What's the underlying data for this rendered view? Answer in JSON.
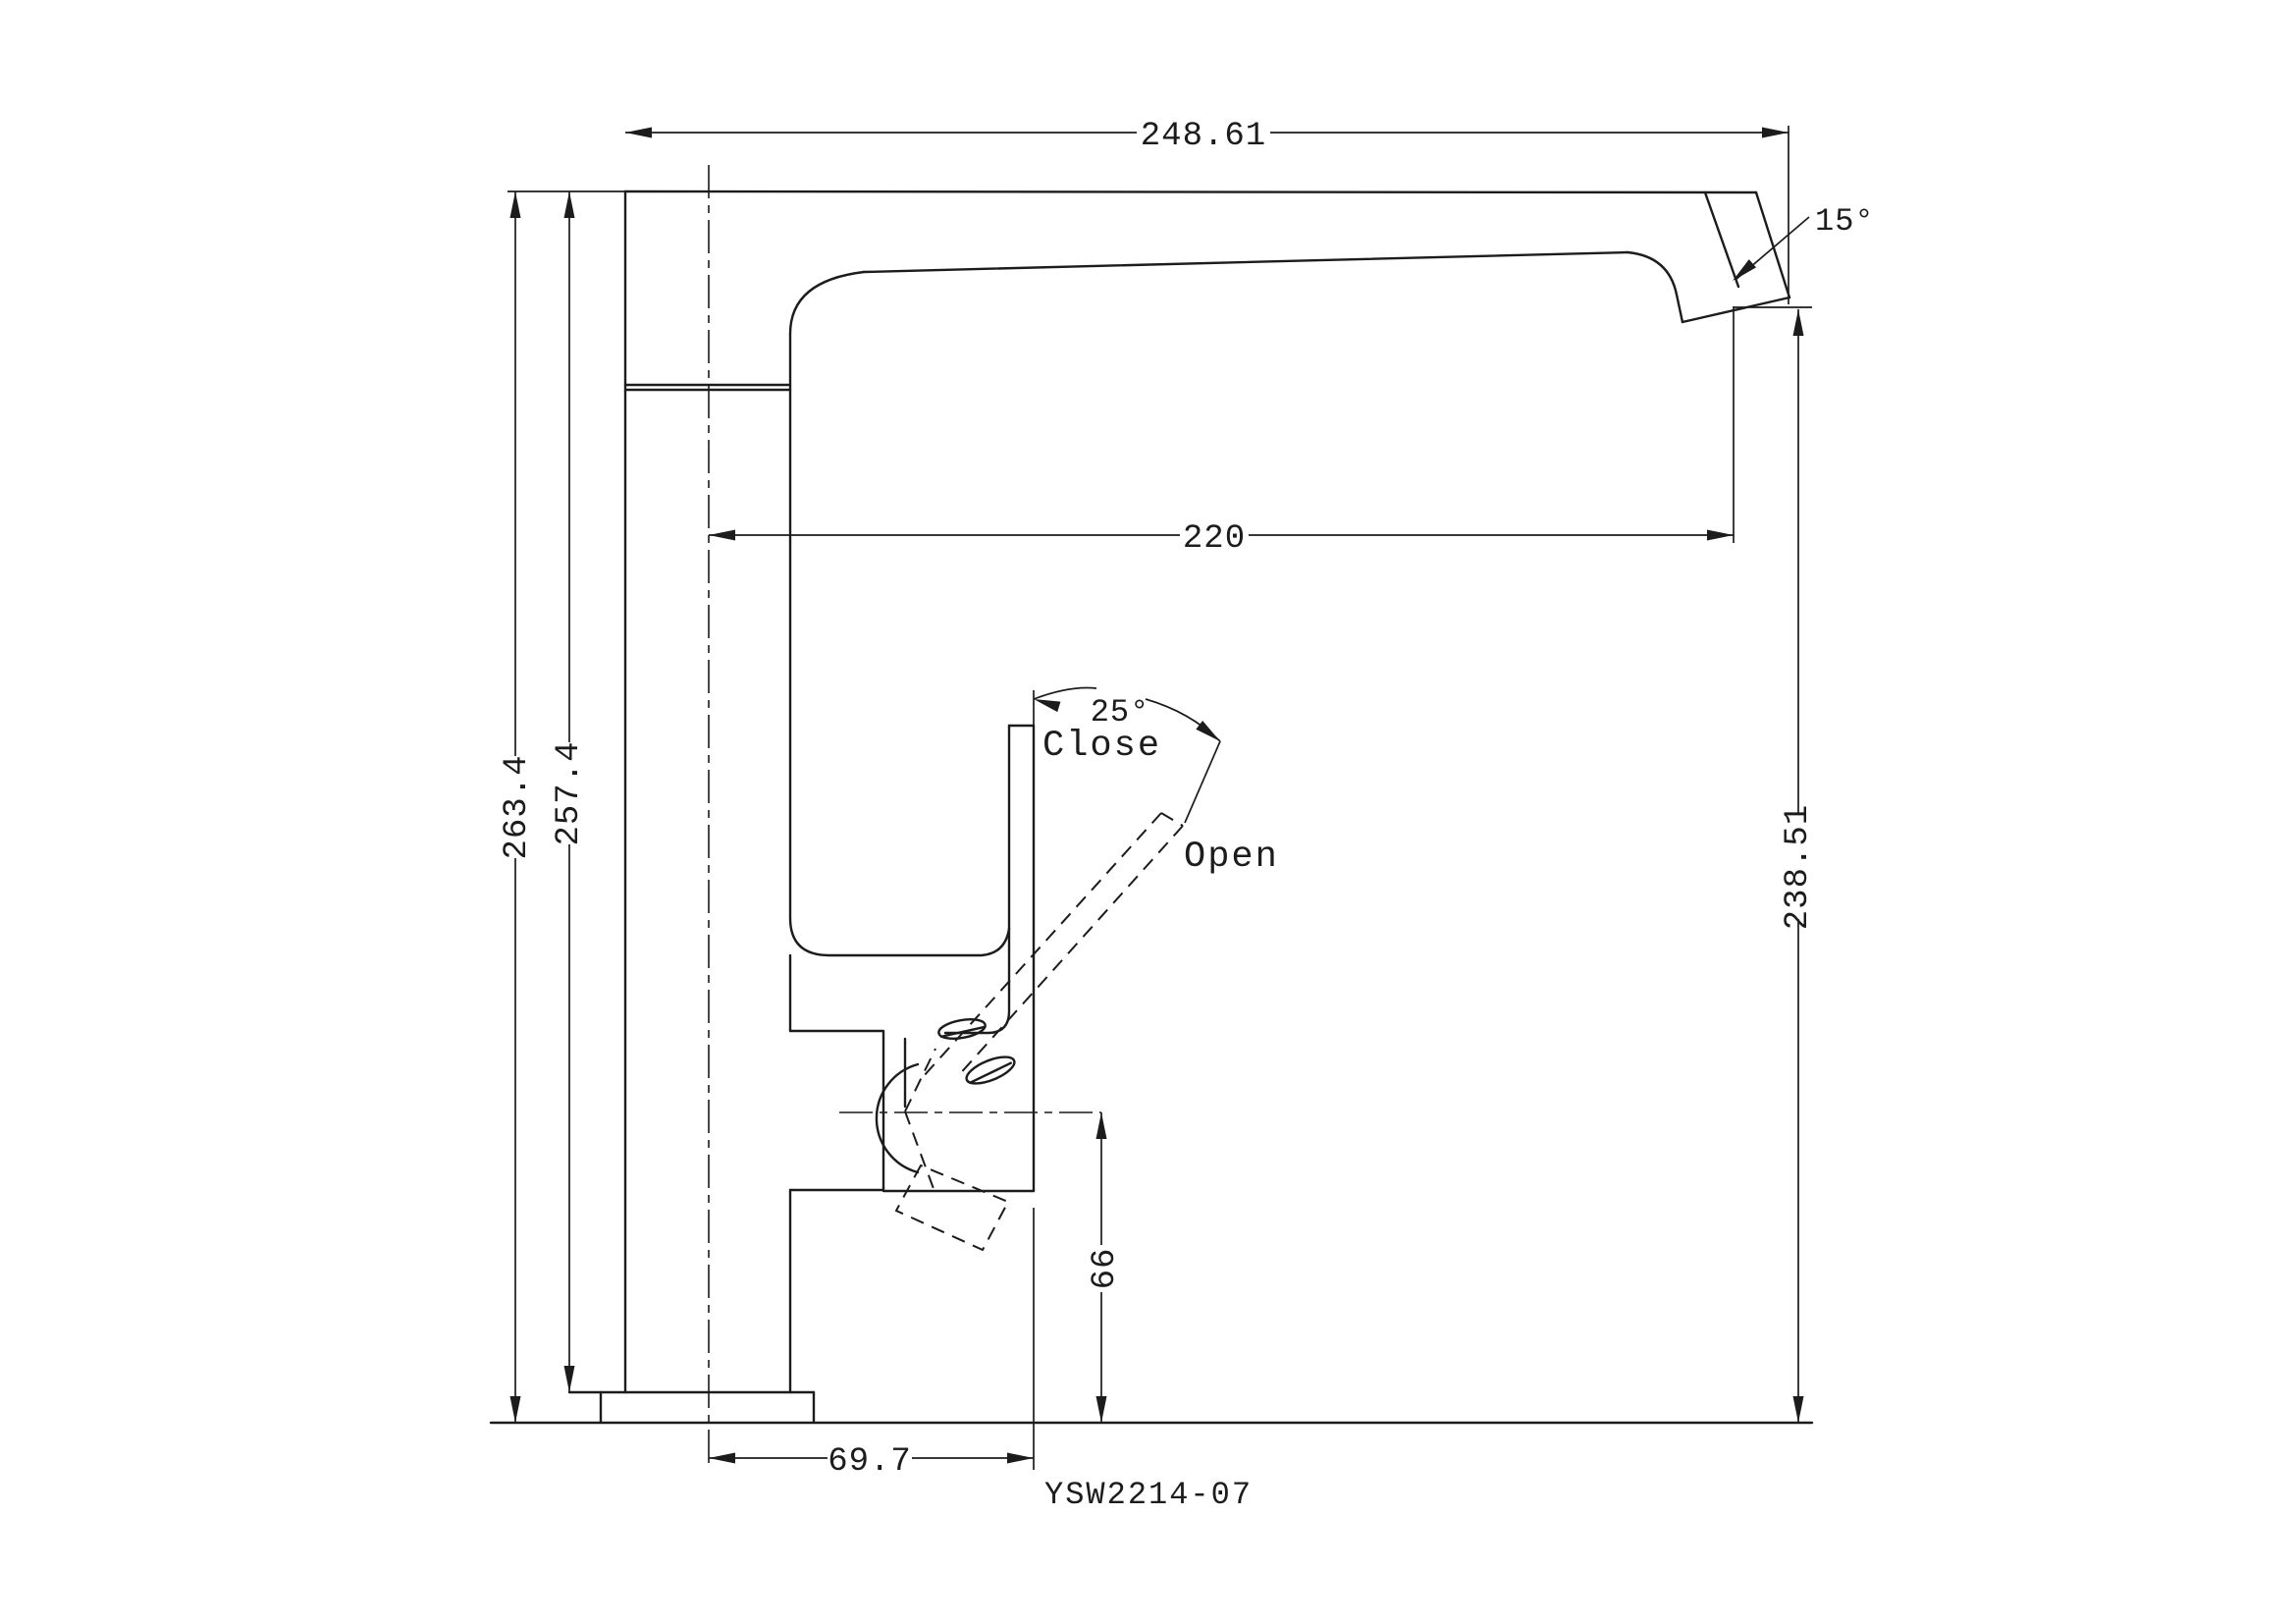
{
  "drawing": {
    "model_number": "YSW2214-07",
    "dimension_labels": {
      "total_width": "248.61",
      "overall_height": "263.4",
      "height_above_base": "257.4",
      "spout_reach": "220",
      "outlet_height": "238.51",
      "handle_center_height": "66",
      "handle_reach": "69.7",
      "outlet_angle": "15°",
      "handle_swing_angle": "25°"
    },
    "annotations": {
      "close_label": "Close",
      "open_label": "Open"
    },
    "colors": {
      "line_color": "#1c1c1c",
      "background": "#ffffff"
    }
  }
}
